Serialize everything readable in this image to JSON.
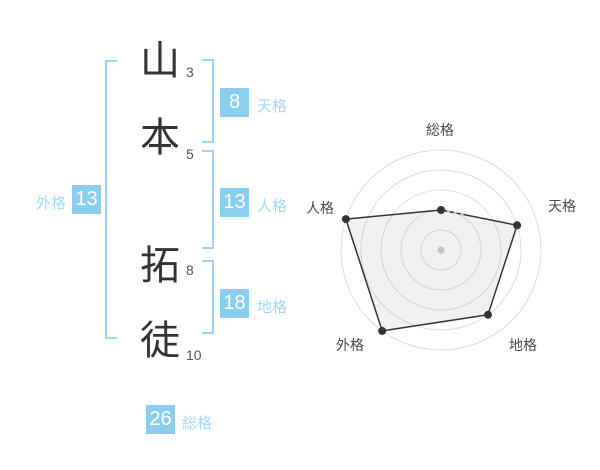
{
  "name": {
    "characters": [
      {
        "char": "山",
        "strokes": 3
      },
      {
        "char": "本",
        "strokes": 5
      },
      {
        "char": "拓",
        "strokes": 8
      },
      {
        "char": "徒",
        "strokes": 10
      }
    ]
  },
  "gaku": {
    "tenkaku": {
      "label": "天格",
      "value": 8
    },
    "jinkaku": {
      "label": "人格",
      "value": 13
    },
    "chikaku": {
      "label": "地格",
      "value": 18
    },
    "gaikaku": {
      "label": "外格",
      "value": 13
    },
    "soukaku": {
      "label": "総格",
      "value": 26
    }
  },
  "chart_data": {
    "type": "radar",
    "categories": [
      "総格",
      "天格",
      "地格",
      "外格",
      "人格"
    ],
    "values": [
      2,
      4,
      4,
      5,
      5
    ],
    "max": 5,
    "rings": 5,
    "title": "",
    "legend_position": "none",
    "grid": "concentric-circles",
    "colors": {
      "ring": "#dddddd",
      "line": "#333333",
      "point": "#333333",
      "fill": "rgba(170,170,170,0.16)",
      "center_dot": "#c9c9c9",
      "dash": "#c4c4c4"
    }
  },
  "ui_colors": {
    "accent_blue": "#8CCEF0",
    "bracket_blue": "#9ED4F3",
    "label_blue": "#A5D8F5",
    "ink": "#333333"
  }
}
